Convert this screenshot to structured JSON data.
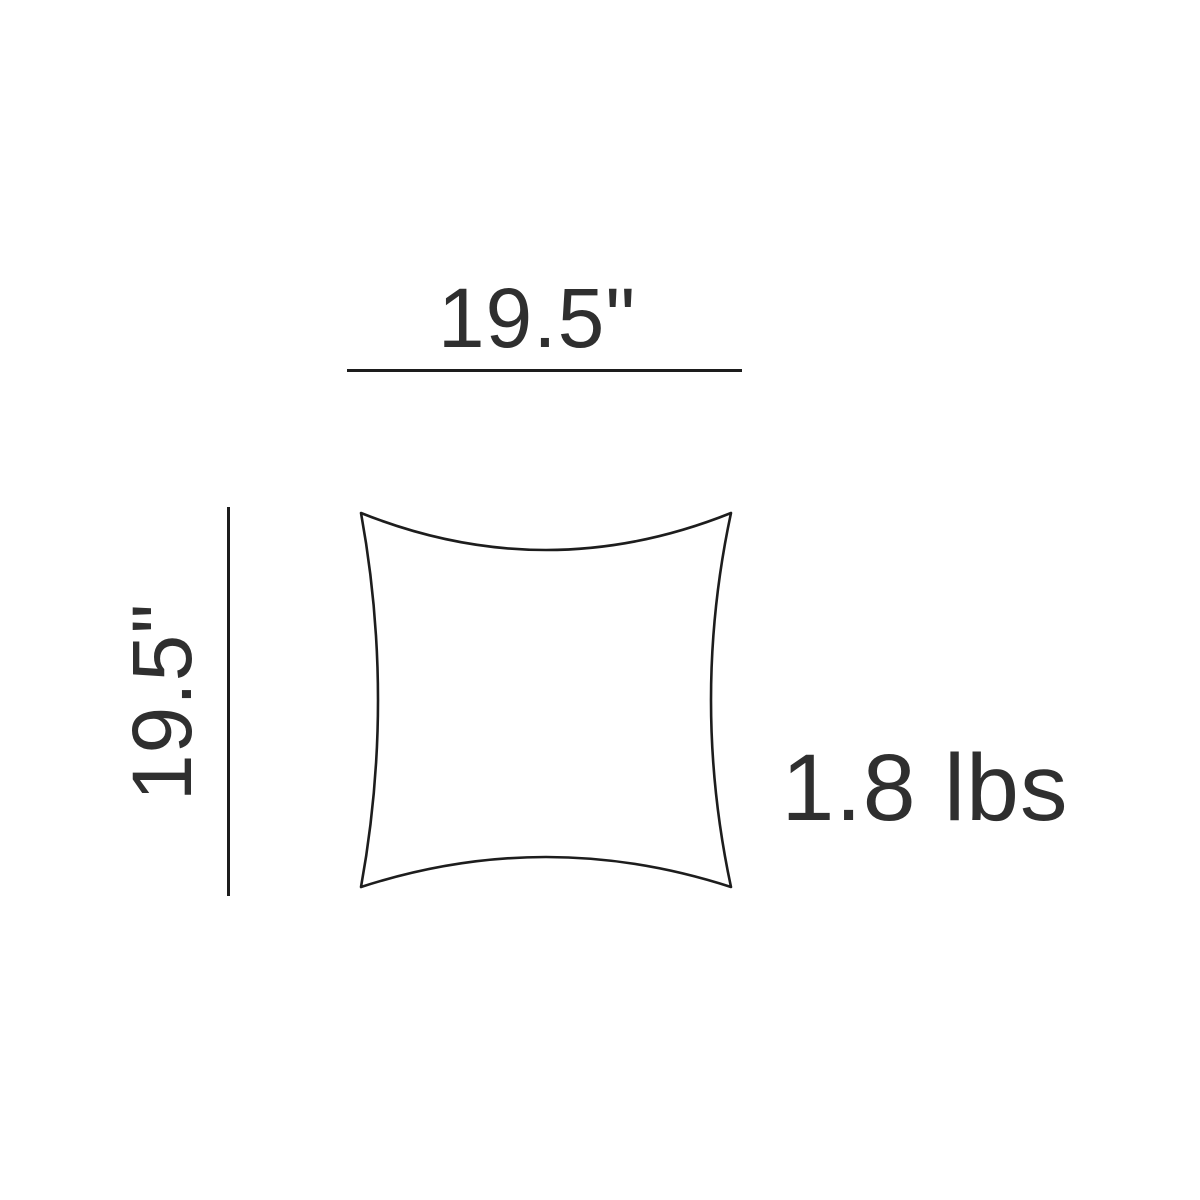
{
  "diagram": {
    "width_dimension": {
      "label": "19.5\""
    },
    "height_dimension": {
      "label": "19.5\""
    },
    "weight": {
      "label": "1.8 lbs"
    },
    "shape": "pillow-outline",
    "colors": {
      "line": "#1d1d1d",
      "text": "#2f2f2f",
      "background": "#ffffff"
    }
  }
}
